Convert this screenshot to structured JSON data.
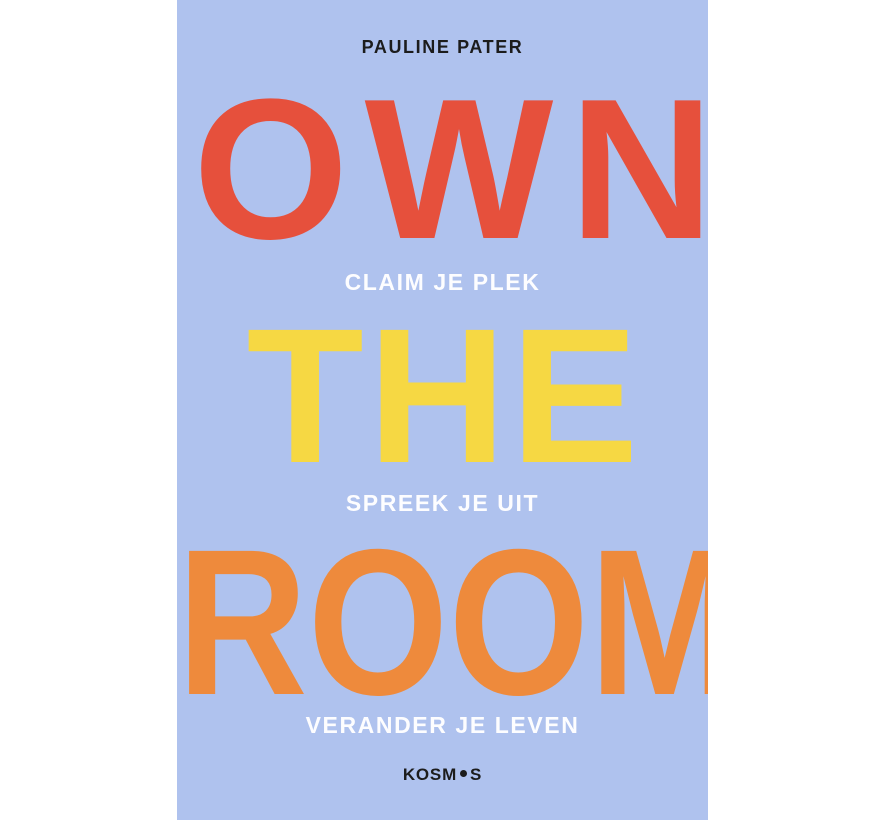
{
  "book_cover": {
    "author": "PAULINE PATER",
    "title": {
      "line1": "OWN",
      "line2": "THE",
      "line3": "ROOM"
    },
    "taglines": {
      "line1": "CLAIM JE PLEK",
      "line2": "SPREEK JE UIT",
      "line3": "VERANDER JE LEVEN"
    },
    "publisher_logo": {
      "text_before_dot": "KOSM",
      "text_after_dot": "S"
    },
    "colors": {
      "canvas_background": "#FFFFFF",
      "cover_background": "#AFC2EE",
      "title_own": "#E6503C",
      "title_the": "#F6D843",
      "title_room": "#EE8A3C",
      "tagline_text": "#FDFDFF",
      "author_text": "#1C1C1C",
      "publisher_text": "#1C1C1C"
    }
  }
}
